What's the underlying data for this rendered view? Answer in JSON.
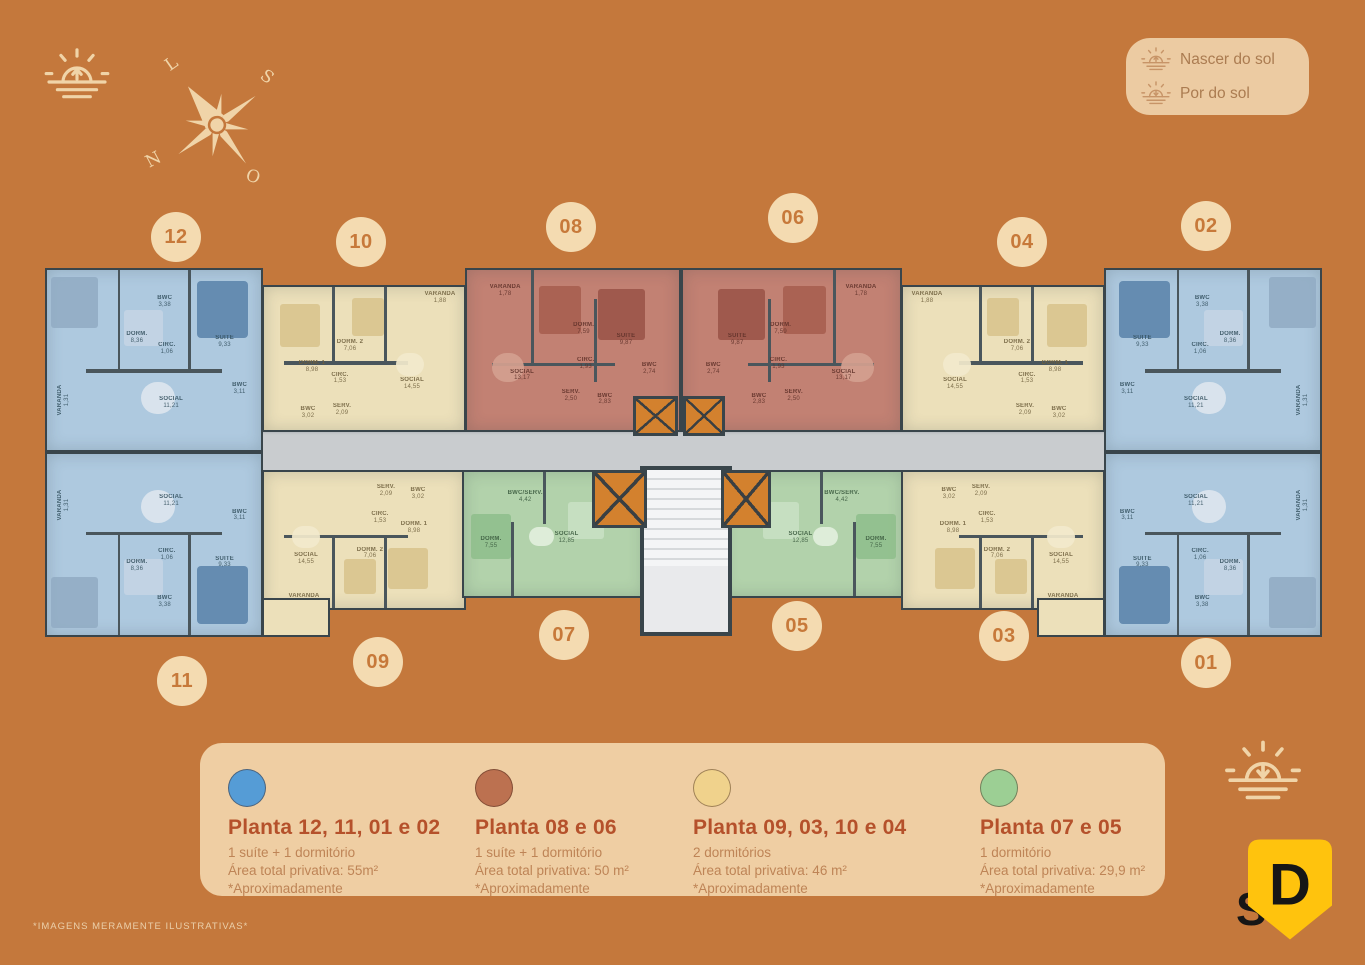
{
  "colors": {
    "background": "#C4783C",
    "cream_icon": "#F0D4A8",
    "panel_bg": "#EFCEA3",
    "info_box_bg": "#ECCBA2",
    "heading_text": "#B5512B",
    "body_text": "#BE8456",
    "badge_bg": "#F4DBB1",
    "badge_text": "#C7793A",
    "wall": "#39454B",
    "corridor": "#C9CCCF",
    "elevator": "#D3812E",
    "stairs": "#E9EAEC",
    "logo_yellow": "#FFC30D",
    "logo_letter_color": "#161616"
  },
  "sun_legend": {
    "sunrise_label": "Nascer do sol",
    "sunset_label": "Por do sol"
  },
  "compass": {
    "east": "L",
    "south": "S",
    "north": "N",
    "west": "O"
  },
  "floorplan": {
    "plantas": {
      "blue": {
        "fill": "#AEC9DF",
        "label_color": "#33505E",
        "rooms": [
          {
            "name": "VARANDA",
            "area": "1,31"
          },
          {
            "name": "DORM.",
            "area": "8,36"
          },
          {
            "name": "BWC",
            "area": "3,38"
          },
          {
            "name": "CIRC.",
            "area": "1,06"
          },
          {
            "name": "SUITE",
            "area": "9,33"
          },
          {
            "name": "SOCIAL",
            "area": "11,21"
          },
          {
            "name": "BWC",
            "area": "3,11"
          }
        ]
      },
      "yellow": {
        "fill": "#ECE0BA",
        "label_color": "#6E5F3C",
        "rooms": [
          {
            "name": "VARANDA",
            "area": "1,88"
          },
          {
            "name": "DORM. 2",
            "area": "7,06"
          },
          {
            "name": "DORM. 1",
            "area": "8,98"
          },
          {
            "name": "CIRC.",
            "area": "1,53"
          },
          {
            "name": "SOCIAL",
            "area": "14,55"
          },
          {
            "name": "SERV.",
            "area": "2,09"
          },
          {
            "name": "BWC",
            "area": "3,02"
          }
        ]
      },
      "red": {
        "fill": "#C28173",
        "label_color": "#5F3129",
        "rooms": [
          {
            "name": "VARANDA",
            "area": "1,78"
          },
          {
            "name": "DORM.",
            "area": "7,59"
          },
          {
            "name": "SUITE",
            "area": "9,87"
          },
          {
            "name": "CIRC.",
            "area": "1,93"
          },
          {
            "name": "SOCIAL",
            "area": "13,17"
          },
          {
            "name": "SERV.",
            "area": "2,50"
          },
          {
            "name": "BWC",
            "area": "2,83"
          },
          {
            "name": "BWC",
            "area": "2,74"
          }
        ]
      },
      "green": {
        "fill": "#B2D2AB",
        "label_color": "#3A5A3E",
        "rooms": [
          {
            "name": "BWC/SERV.",
            "area": "4,42"
          },
          {
            "name": "DORM.",
            "area": "7,55"
          },
          {
            "name": "SOCIAL",
            "area": "12,85"
          }
        ]
      }
    },
    "units": [
      {
        "id": "12",
        "planta": "blue"
      },
      {
        "id": "11",
        "planta": "blue"
      },
      {
        "id": "10",
        "planta": "yellow"
      },
      {
        "id": "09",
        "planta": "yellow"
      },
      {
        "id": "08",
        "planta": "red"
      },
      {
        "id": "06",
        "planta": "red"
      },
      {
        "id": "07",
        "planta": "green"
      },
      {
        "id": "05",
        "planta": "green"
      },
      {
        "id": "04",
        "planta": "yellow"
      },
      {
        "id": "03",
        "planta": "yellow"
      },
      {
        "id": "02",
        "planta": "blue"
      },
      {
        "id": "01",
        "planta": "blue"
      }
    ],
    "badges": [
      "12",
      "10",
      "08",
      "06",
      "04",
      "02",
      "11",
      "09",
      "07",
      "05",
      "03",
      "01"
    ]
  },
  "legend": {
    "items": [
      {
        "circle_color": "#559CD6",
        "title": "Planta 12, 11, 01 e 02",
        "line1": "1 suíte + 1 dormitório",
        "line2": "Área total privativa: 55m²",
        "line3": "*Aproximadamente"
      },
      {
        "circle_color": "#BC7150",
        "title": "Planta 08 e 06",
        "line1": "1 suíte + 1 dormitório",
        "line2": "Área total privativa: 50 m²",
        "line3": "*Aproximadamente"
      },
      {
        "circle_color": "#F0D28C",
        "title": "Planta 09, 03, 10 e 04",
        "line1": "2 dormitórios",
        "line2": "Área total privativa: 46 m²",
        "line3": "*Aproximadamente"
      },
      {
        "circle_color": "#9CCF94",
        "title": "Planta 07 e 05",
        "line1": "1 dormitório",
        "line2": "Área total privativa: 29,9 m²",
        "line3": "*Aproximadamente"
      }
    ]
  },
  "disclaimer": "*IMAGENS MERAMENTE ILUSTRATIVAS*",
  "logo": {
    "letter": "D",
    "partial_text": "S"
  }
}
